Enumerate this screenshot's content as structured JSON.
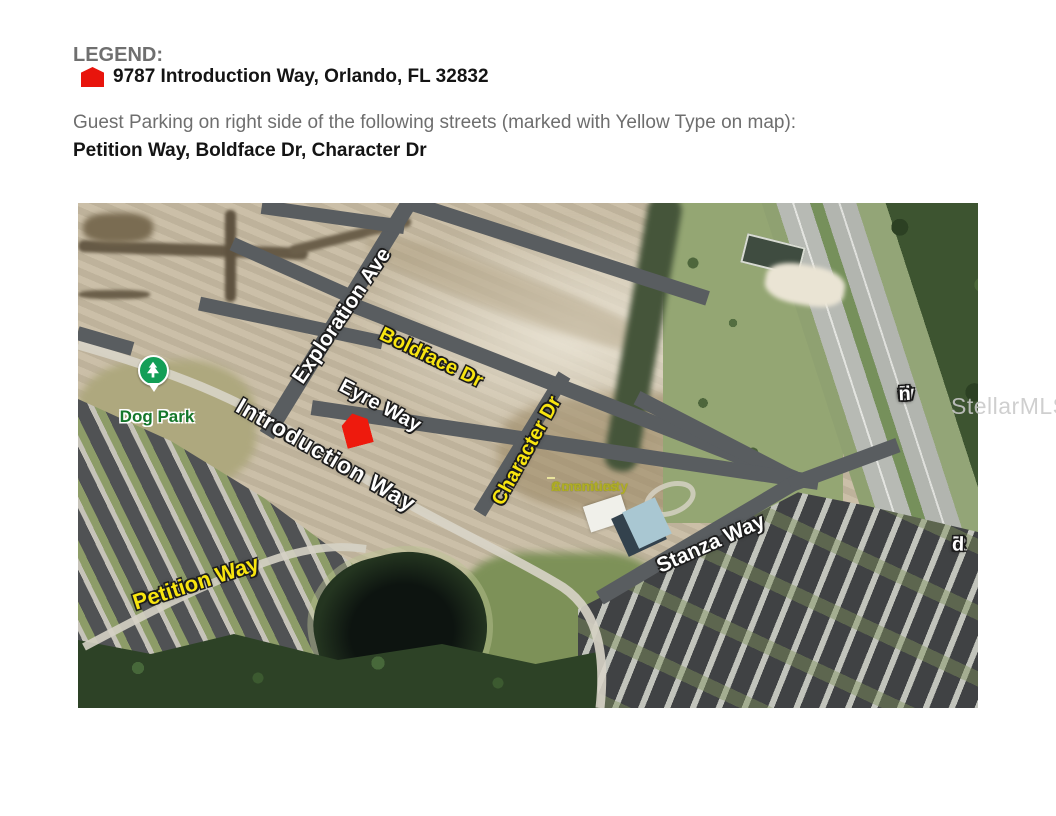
{
  "legend": {
    "title": "LEGEND:",
    "marker_label": "9787 Introduction Way, Orlando, FL 32832",
    "parking_note": "Guest Parking on right side of the following streets (marked with Yellow Type on map):",
    "parking_streets": "Petition Way, Boldface Dr, Character Dr"
  },
  "map": {
    "streets": {
      "exploration": "Exploration Ave",
      "boldface": "Boldface Dr",
      "eyre": "Eyre Way",
      "introduction": "Introduction Way",
      "character": "Character Dr",
      "stanza": "Stanza Way",
      "petition": "Petition Way",
      "dowden": "Dowden",
      "dowden_suffix": "Rd"
    },
    "places": {
      "dog_park": "Dog Park",
      "community_line1": "Community",
      "community_line2": "Amenities"
    },
    "watermark": "StellarMLS",
    "colors": {
      "guest_parking_street_label": "#f8e50f",
      "standard_street_label": "#ffffff",
      "subject_marker": "#ee1a0d",
      "road_overlay": "#595d60",
      "dog_park_label": "#15772b"
    }
  }
}
